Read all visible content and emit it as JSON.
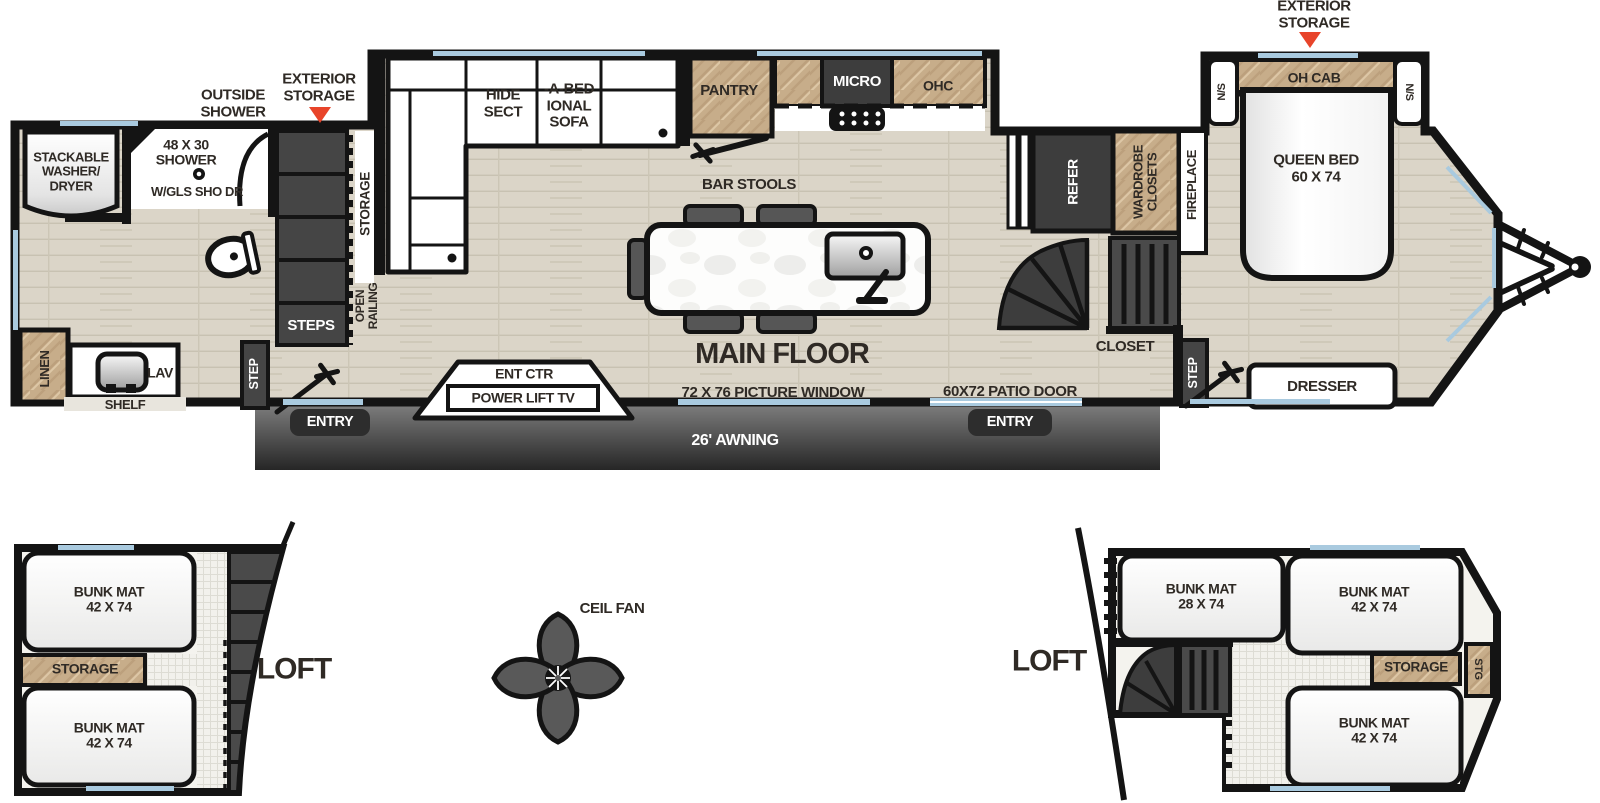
{
  "colors": {
    "wall": "#141414",
    "floor_wood": "#dbd5c8",
    "cabinet_wood": "#c7ad8a",
    "dark_fixture": "#454545",
    "awning_gray": "#3a3a3a",
    "accent_red": "#e8442a",
    "window_blue": "#a9cadf",
    "text": "#2f2a25"
  },
  "callouts": {
    "outside_shower": [
      "OUTSIDE",
      "SHOWER"
    ],
    "exterior_storage_rear": [
      "EXTERIOR",
      "STORAGE"
    ],
    "exterior_storage_front": [
      "EXTERIOR",
      "STORAGE"
    ],
    "ceiling_fan": "CEIL FAN"
  },
  "main_floor": {
    "title": "MAIN FLOOR",
    "bath": {
      "washer_dryer": [
        "STACKABLE",
        "WASHER/",
        "DRYER"
      ],
      "shower": [
        "48 X 30",
        "SHOWER"
      ],
      "shower_door": "W/GLS SHO DR",
      "linen": "LINEN",
      "lav": "LAV",
      "shelf": "SHELF"
    },
    "rear_stairs": {
      "steps": "STEPS",
      "storage": "STORAGE",
      "open_railing": [
        "OPEN",
        "RAILING"
      ],
      "step": "STEP"
    },
    "living": {
      "sofa": [
        "HIDE",
        "SECT",
        "-A-BED",
        "IONAL",
        "SOFA"
      ],
      "pantry": "PANTRY",
      "micro": "MICRO",
      "ohc": "OHC",
      "bar_stools": "BAR STOOLS",
      "ent_ctr": "ENT CTR",
      "power_lift_tv": "POWER LIFT TV",
      "picture_window": "72 X 76 PICTURE WINDOW"
    },
    "galley": {
      "refer": "REFER",
      "wardrobe": [
        "WARDROBE",
        "CLOSETS"
      ],
      "fireplace": "FIREPLACE",
      "closet": "CLOSET",
      "patio_door": "60X72 PATIO DOOR"
    },
    "bedroom": {
      "oh_cab": "OH CAB",
      "ns_left": "N/S",
      "ns_right": "N/S",
      "queen_bed": [
        "QUEEN BED",
        "60 X 74"
      ],
      "dresser": "DRESSER",
      "step": "STEP"
    },
    "exterior": {
      "awning": "26' AWNING",
      "entry_left": "ENTRY",
      "entry_right": "ENTRY"
    }
  },
  "lofts": {
    "left": {
      "label": "LOFT",
      "bunk_top": [
        "BUNK MAT",
        "42 X 74"
      ],
      "storage": "STORAGE",
      "bunk_bottom": [
        "BUNK MAT",
        "42 X 74"
      ]
    },
    "right": {
      "label": "LOFT",
      "bunk_side": [
        "BUNK MAT",
        "28 X 74"
      ],
      "bunk_top": [
        "BUNK MAT",
        "42 X 74"
      ],
      "storage": "STORAGE",
      "stg": "STG",
      "bunk_bottom": [
        "BUNK MAT",
        "42 X 74"
      ]
    }
  }
}
